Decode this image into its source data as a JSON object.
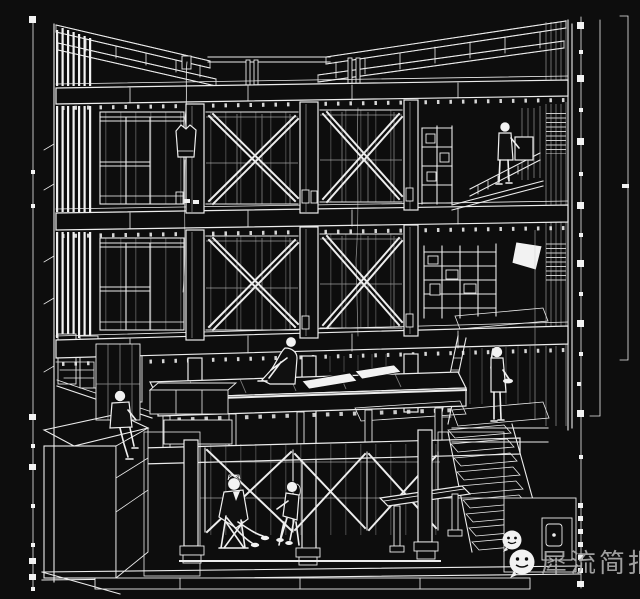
{
  "meta": {
    "title": "Architectural sectional perspective drawing (white wireframe on black)",
    "background_color": "#0d0d0d",
    "line_color": "#ececec",
    "style": "hand-drafted building section with cutaway interior"
  },
  "watermark": {
    "text": "犀流简报",
    "text_color": "#ababab",
    "icons": [
      "wechat-chat-bubble-icon",
      "wechat-chat-bubble-icon"
    ]
  },
  "scene": {
    "building": {
      "floors": [
        {
          "name": "roof",
          "features": [
            "butterfly V-roof",
            "ladder trusses sloping to center",
            "hanging coat on wire"
          ]
        },
        {
          "name": "third-floor",
          "features": [
            "window bay",
            "two X-braced bays",
            "shelf unit",
            "stair balustrade",
            "standing person at shelf"
          ]
        },
        {
          "name": "second-floor",
          "features": [
            "window bay",
            "two X-braced bays",
            "storage scaffold",
            "white pendant lamp",
            "planted stipple strip"
          ]
        },
        {
          "name": "ground-floor",
          "features": [
            "open pilotis",
            "raised timber deck",
            "sitting person",
            "stippled counter with seated person",
            "landing with standing person",
            "stair run down"
          ]
        },
        {
          "name": "basement",
          "features": [
            "X-braced stud walls",
            "two seated people talking",
            "low bench",
            "column footings"
          ]
        }
      ],
      "people": [
        {
          "id": "person-third-floor-standing",
          "pose": "standing, reaching to wall box"
        },
        {
          "id": "person-deck-sitting",
          "pose": "sitting with knees up on deck"
        },
        {
          "id": "person-counter-sitting",
          "pose": "sitting on counter edge, legs dangling"
        },
        {
          "id": "person-landing-standing",
          "pose": "standing holding a dish"
        },
        {
          "id": "person-basement-suit",
          "pose": "seated on chair, legs extended"
        },
        {
          "id": "person-basement-companion",
          "pose": "seated on stool, facing companion"
        }
      ]
    },
    "annotations": {
      "left_scale_bar": "vertical line with square tick marks",
      "right_scale_bar": "vertical line with square tick marks",
      "right_brackets": "two thin vertical extent lines with end caps"
    }
  }
}
